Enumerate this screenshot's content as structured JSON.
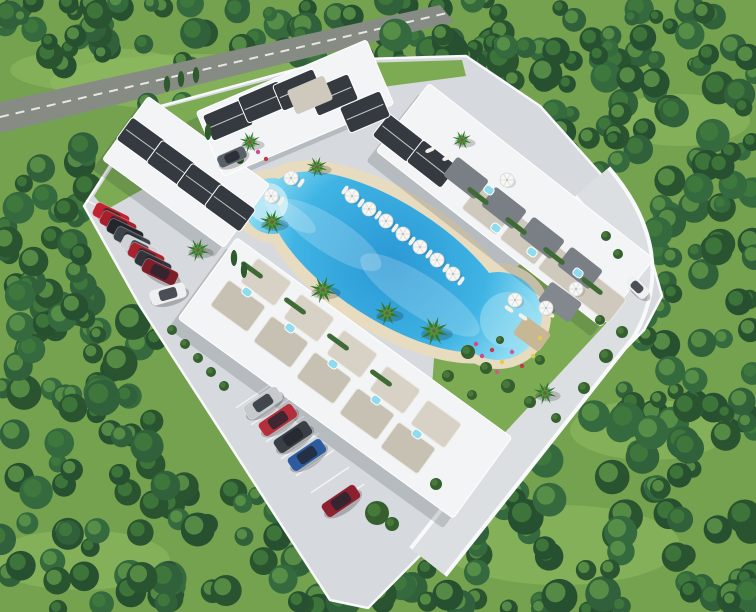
{
  "canvas": {
    "w": 756,
    "h": 612
  },
  "scene_label": "aerial-3d-render-of-resort-residential-complex-with-lagoon-pool",
  "palette": {
    "grass": "#74a24e",
    "meadow": "#8fbb62",
    "tree_greens": [
      "#2a5330",
      "#30613a",
      "#275031",
      "#346a3e"
    ],
    "tree_hi": "#5d9449",
    "tree_mid": "#417a3c",
    "road": "#868b84",
    "road_line": "#f2f2ee",
    "pavement": "#d6d9dd",
    "curb": "#f8f9fa",
    "driveway": "#dcdfe2",
    "building": "#f3f4f6",
    "building_stroke": "#ffffff",
    "shadow": "rgba(20,30,40,0.16)",
    "roof_dark": "#343a40",
    "roof_ridge": "#e8e8e8",
    "roof_tan_outer": "#c7c1b3",
    "roof_tan_inner": "#d8d2c6",
    "canopy_gray": "#7a7f85",
    "tile_tan": "#cfc9bd",
    "deck": "#e8dcc0",
    "pool_stops": [
      [
        "0",
        "#2b98d5"
      ],
      [
        "0.55",
        "#3fb4e4"
      ],
      [
        "0.85",
        "#8edcf2"
      ],
      [
        "1",
        "#b9ecf8"
      ]
    ],
    "jacuzzi": "#8fdcee",
    "hedge": "#3e6b35",
    "bush_dark": "#355f2f",
    "bush_light": "#46793a",
    "palm_dark": "#39752f",
    "palm_light": "#4f9440",
    "trunk": "#7a5a38",
    "lounger": "#f4f1ea",
    "umbrella": "#f7f7f5",
    "umbrella_rib": "#d8d8d4",
    "garden": "#7cab54",
    "flower_colors": [
      "#cf4a8e",
      "#c43848",
      "#e0cc52",
      "#d05a96"
    ]
  },
  "meadows": [
    [
      200,
      82,
      150,
      28
    ],
    [
      100,
      70,
      90,
      22
    ],
    [
      680,
      120,
      70,
      26
    ],
    [
      560,
      545,
      120,
      40
    ],
    [
      80,
      560,
      90,
      30
    ],
    [
      650,
      430,
      80,
      30
    ]
  ],
  "forest": {
    "seed": 11,
    "back_zones": [
      [
        0,
        0,
        756,
        66,
        95,
        7,
        16
      ]
    ],
    "front_zones": [
      [
        380,
        34,
        376,
        116,
        62,
        8,
        17
      ],
      [
        460,
        130,
        296,
        130,
        58,
        8,
        17
      ],
      [
        620,
        240,
        136,
        190,
        42,
        8,
        16
      ],
      [
        470,
        400,
        286,
        212,
        72,
        9,
        18
      ],
      [
        150,
        478,
        330,
        134,
        58,
        9,
        18
      ],
      [
        0,
        300,
        175,
        312,
        68,
        9,
        18
      ],
      [
        0,
        138,
        112,
        200,
        40,
        8,
        16
      ],
      [
        100,
        98,
        225,
        72,
        13,
        6,
        12
      ]
    ]
  },
  "road": {
    "outline": "0,102 440,5 454,22 0,133",
    "line": [
      0,
      117,
      447,
      13
    ]
  },
  "plot": {
    "outline": "84,206 146,110 330,60 466,56 540,106 640,218 662,296 644,330 368,608 330,600 140,306"
  },
  "driveway": {
    "path": "M 592,182 Q 654,254 616,324 L 428,562",
    "outer_w": 48,
    "inner_w": 40
  },
  "gardens": [
    {
      "outline": "436,330 536,252 600,282 622,306 600,330 470,470 430,416"
    },
    {
      "outline": "94,196 148,112 330,64 462,60 466,76 344,92 168,175 106,210"
    }
  ],
  "pool": {
    "deck": [
      [
        390,
        262,
        152,
        70,
        33
      ],
      [
        498,
        316,
        53,
        53,
        0
      ],
      [
        272,
        206,
        37,
        37,
        0
      ]
    ],
    "water": [
      [
        390,
        262,
        140,
        58,
        33
      ],
      [
        498,
        316,
        44,
        44,
        0
      ],
      [
        272,
        206,
        28,
        28,
        0
      ]
    ],
    "shallow": [
      [
        268,
        203,
        20,
        "#c2ebf7",
        0.85
      ],
      [
        508,
        320,
        28,
        "#9fdef2",
        0.55
      ]
    ],
    "caustics": [
      [
        330,
        235,
        60,
        18
      ],
      [
        420,
        295,
        70,
        20
      ],
      [
        290,
        215,
        30,
        10
      ]
    ],
    "grad": {
      "cx": 390,
      "cy": 262,
      "r": 178
    }
  },
  "bands": [
    [
      186,
      172,
      150,
      78,
      36
    ],
    [
      295,
      108,
      185,
      70,
      -23
    ],
    [
      515,
      205,
      285,
      86,
      38
    ],
    [
      345,
      378,
      340,
      100,
      36
    ]
  ],
  "roofs": {
    "dark": [
      [
        142,
        141,
        36
      ],
      [
        172,
        164,
        36
      ],
      [
        202,
        187,
        36
      ],
      [
        230,
        208,
        36
      ],
      [
        398,
        138,
        38
      ],
      [
        432,
        164,
        38
      ],
      [
        228,
        120,
        -23
      ],
      [
        263,
        102,
        -23
      ],
      [
        298,
        90,
        -23
      ],
      [
        333,
        95,
        -23
      ],
      [
        365,
        112,
        -23
      ]
    ],
    "dark_size": [
      44,
      28
    ],
    "tan_outer": [
      [
        238,
        306
      ],
      [
        281,
        342
      ],
      [
        324,
        378
      ],
      [
        367,
        414
      ],
      [
        408,
        448
      ]
    ],
    "tan_outer_size": [
      46,
      32
    ],
    "tan_inner": [
      [
        266,
        282
      ],
      [
        309,
        318
      ],
      [
        352,
        354
      ],
      [
        395,
        390
      ],
      [
        436,
        424
      ]
    ],
    "tan_inner_size": [
      42,
      30
    ],
    "tan_rot": 36,
    "ne_tiles": [
      [
        488,
        210
      ],
      [
        526,
        240
      ],
      [
        564,
        270
      ],
      [
        600,
        298
      ]
    ],
    "ne_tiles_size": [
      44,
      30
    ],
    "canopies": [
      [
        466,
        178
      ],
      [
        504,
        208
      ],
      [
        542,
        238
      ],
      [
        580,
        268
      ]
    ],
    "canopy_size": [
      40,
      24
    ],
    "n_tan": [
      [
        310,
        95
      ]
    ],
    "n_tan_size": [
      40,
      26
    ],
    "n_tan_rot": -23,
    "ne_rot": 38
  },
  "jacuzzis": [
    [
      489,
      190
    ],
    [
      532,
      252
    ],
    [
      578,
      273
    ],
    [
      496,
      228
    ],
    [
      247,
      292
    ],
    [
      290,
      328
    ],
    [
      333,
      364
    ],
    [
      376,
      400
    ],
    [
      417,
      434
    ]
  ],
  "jacuzzi_rot": 37,
  "hedges": [
    [
      252,
      270,
      36
    ],
    [
      295,
      306,
      36
    ],
    [
      338,
      342,
      36
    ],
    [
      381,
      378,
      36
    ],
    [
      478,
      196,
      38
    ],
    [
      516,
      226,
      38
    ],
    [
      554,
      256,
      38
    ],
    [
      592,
      286,
      38
    ]
  ],
  "pergolas": [
    [
      560,
      302,
      38,
      24,
      36,
      "#83888e"
    ],
    [
      532,
      334,
      32,
      22,
      36,
      "#c8b794"
    ]
  ],
  "stalls": {
    "nw": {
      "start": [
        104,
        209
      ],
      "step": [
        7,
        8
      ],
      "count": 9,
      "angle": 26,
      "len": 40
    },
    "sw": {
      "start": [
        255,
        395
      ],
      "step": [
        15,
        17
      ],
      "count": 7,
      "angle": -34,
      "len": 46
    }
  },
  "cars": [
    [
      111,
      216,
      26,
      37,
      15,
      "#bf2430"
    ],
    [
      118,
      224,
      26,
      37,
      15,
      "#a81f2c"
    ],
    [
      125,
      232,
      26,
      37,
      15,
      "#23272c"
    ],
    [
      132,
      240,
      26,
      37,
      15,
      "#3d434a"
    ],
    [
      139,
      248,
      26,
      37,
      15,
      "#ced2d5"
    ],
    [
      146,
      256,
      26,
      37,
      15,
      "#a8232e"
    ],
    [
      153,
      264,
      26,
      37,
      15,
      "#30353b"
    ],
    [
      160,
      272,
      26,
      37,
      15,
      "#7c1f2b"
    ],
    [
      168,
      294,
      -16,
      36,
      15,
      "#edeff0"
    ],
    [
      263,
      403,
      -34,
      40,
      16,
      "#c6cacd"
    ],
    [
      278,
      420,
      -34,
      40,
      16,
      "#b32f3b"
    ],
    [
      293,
      437,
      -34,
      40,
      16,
      "#3a3f46"
    ],
    [
      307,
      455,
      -34,
      40,
      16,
      "#2d5c9e"
    ],
    [
      341,
      501,
      -34,
      40,
      16,
      "#8c2130"
    ],
    [
      637,
      287,
      44,
      26,
      12,
      "#eef0f1"
    ],
    [
      232,
      157,
      -24,
      30,
      13,
      "#596067"
    ]
  ],
  "umbrellas": [
    [
      291,
      178
    ],
    [
      271,
      196
    ],
    [
      352,
      196
    ],
    [
      369,
      209
    ],
    [
      386,
      221
    ],
    [
      403,
      234
    ],
    [
      420,
      247
    ],
    [
      437,
      260
    ],
    [
      453,
      274
    ],
    [
      515,
      300
    ],
    [
      546,
      308
    ],
    [
      576,
      289
    ],
    [
      507,
      180
    ]
  ],
  "loungers": [
    [
      345,
      190,
      -55
    ],
    [
      361,
      203,
      -55
    ],
    [
      378,
      215,
      -55
    ],
    [
      395,
      228,
      -55
    ],
    [
      412,
      241,
      -55
    ],
    [
      429,
      254,
      -55
    ],
    [
      301,
      183,
      -55
    ],
    [
      281,
      201,
      -55
    ],
    [
      446,
      268,
      -55
    ],
    [
      461,
      281,
      -55
    ],
    [
      509,
      309,
      36
    ],
    [
      523,
      317,
      36
    ],
    [
      550,
      314,
      36
    ],
    [
      430,
      150,
      -23
    ],
    [
      447,
      158,
      -23
    ]
  ],
  "palms": [
    [
      272,
      222,
      13
    ],
    [
      323,
      290,
      14
    ],
    [
      387,
      313,
      13
    ],
    [
      434,
      331,
      15
    ],
    [
      198,
      250,
      12
    ],
    [
      250,
      142,
      11
    ],
    [
      462,
      140,
      10
    ],
    [
      545,
      393,
      12
    ],
    [
      317,
      167,
      11
    ]
  ],
  "cypresses": [
    [
      234,
      258
    ],
    [
      244,
      270
    ],
    [
      167,
      84
    ],
    [
      181,
      79
    ],
    [
      196,
      75
    ],
    [
      208,
      132
    ]
  ],
  "bushes": [
    [
      468,
      352,
      7
    ],
    [
      486,
      368,
      6
    ],
    [
      508,
      386,
      7
    ],
    [
      530,
      402,
      6
    ],
    [
      556,
      418,
      5
    ],
    [
      584,
      388,
      6
    ],
    [
      606,
      356,
      7
    ],
    [
      622,
      332,
      6
    ],
    [
      540,
      360,
      5
    ],
    [
      500,
      340,
      4
    ],
    [
      472,
      395,
      5
    ],
    [
      448,
      376,
      6
    ],
    [
      172,
      330,
      5
    ],
    [
      185,
      344,
      5
    ],
    [
      198,
      358,
      5
    ],
    [
      211,
      372,
      5
    ],
    [
      224,
      386,
      5
    ],
    [
      606,
      236,
      5
    ],
    [
      618,
      254,
      5
    ],
    [
      377,
      513,
      12
    ],
    [
      392,
      524,
      7
    ],
    [
      436,
      484,
      6
    ],
    [
      240,
      160,
      4
    ],
    [
      600,
      320,
      5
    ]
  ],
  "flowers": [
    [
      482,
      356
    ],
    [
      492,
      350
    ],
    [
      502,
      362
    ],
    [
      512,
      352
    ],
    [
      476,
      344
    ],
    [
      522,
      366
    ],
    [
      533,
      356
    ],
    [
      497,
      372
    ],
    [
      258,
      152
    ],
    [
      266,
      159
    ],
    [
      540,
      338
    ]
  ]
}
